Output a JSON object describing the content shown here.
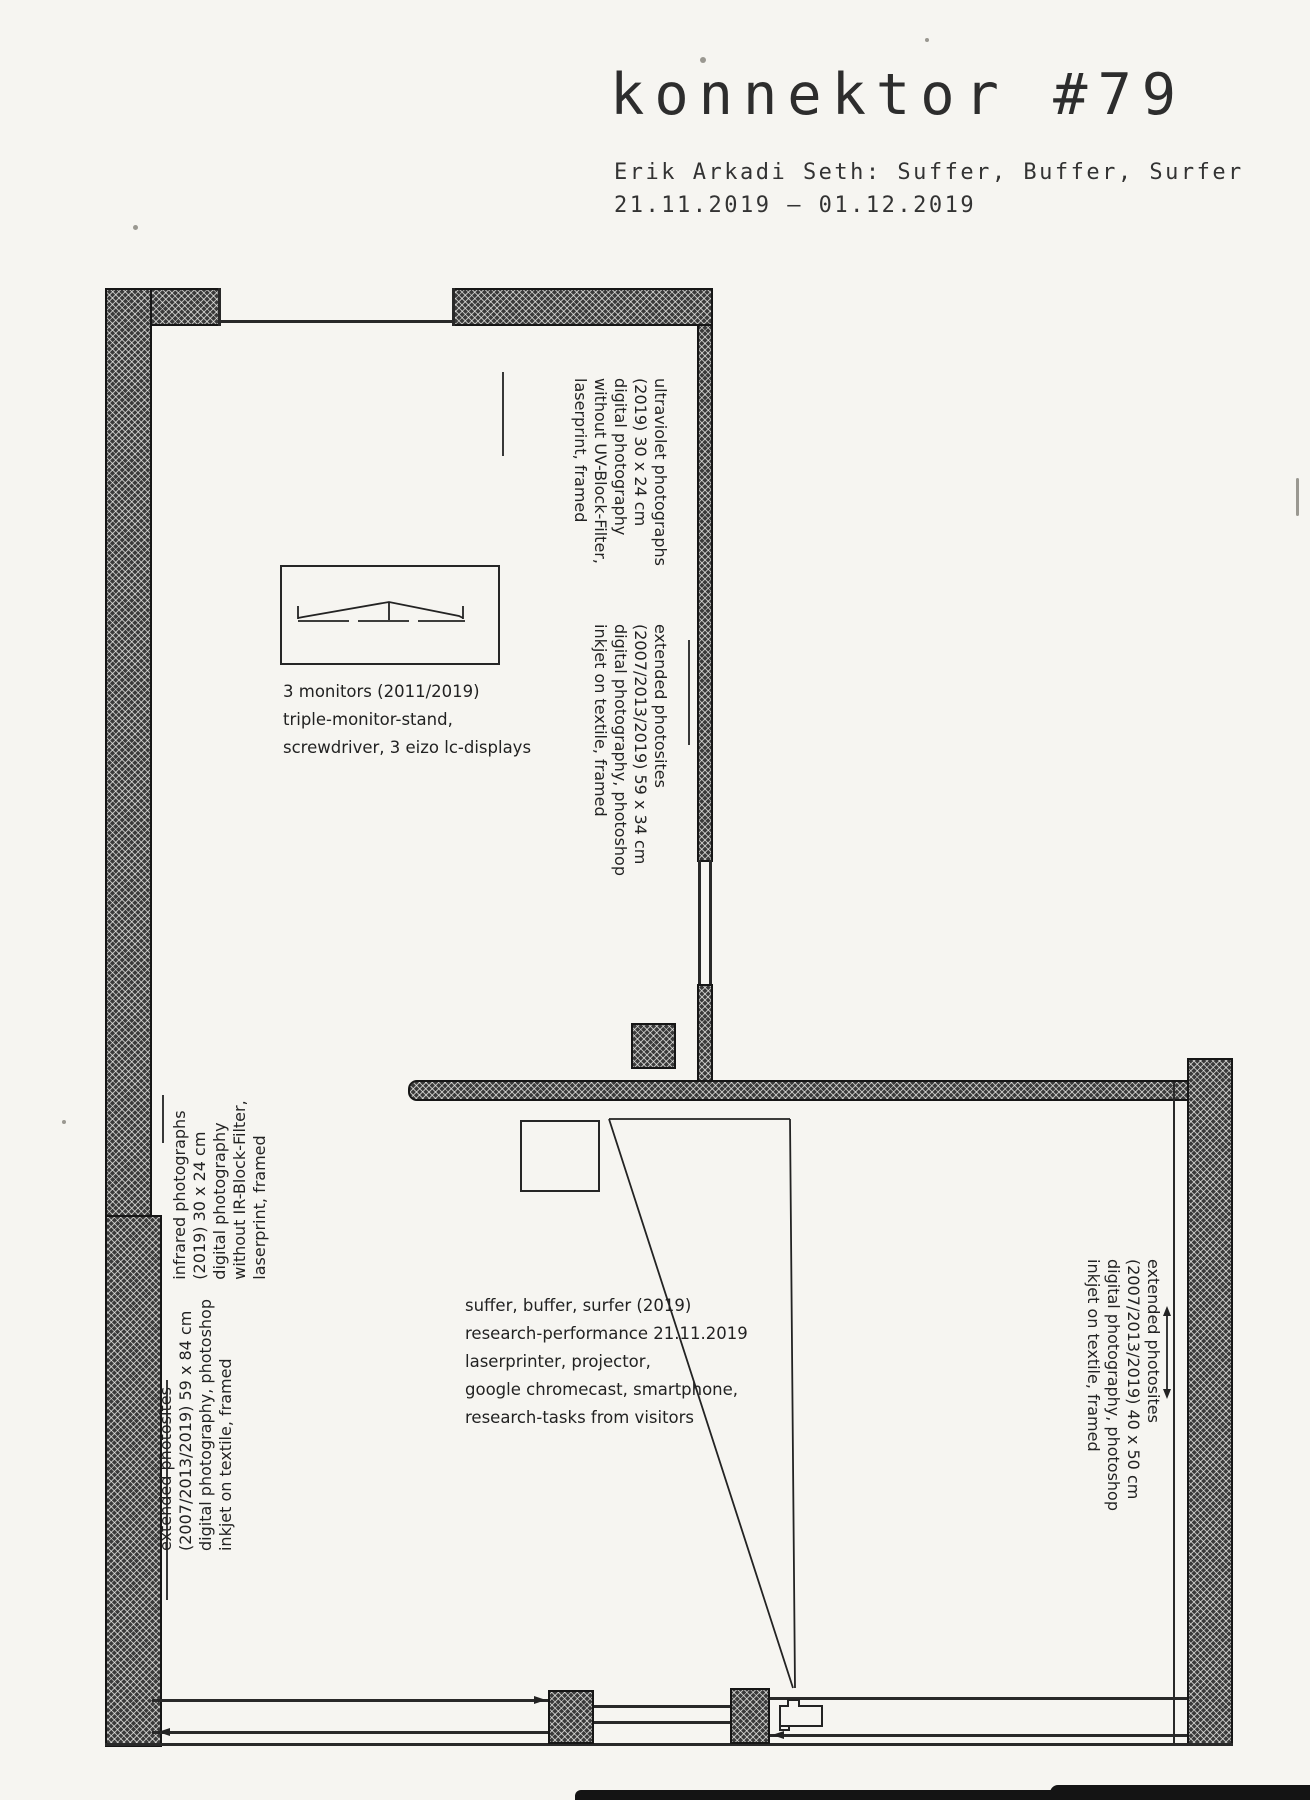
{
  "header": {
    "title": "konnektor #79",
    "subtitle": "Erik Arkadi Seth: Suffer, Buffer, Surfer",
    "dates": "21.11.2019 – 01.12.2019"
  },
  "labels": {
    "ultraviolet": {
      "lines": [
        "ultraviolet photographs",
        "(2019) 30 x 24 cm",
        "digital photography",
        "without UV-Block-Filter,",
        "laserprint, framed"
      ]
    },
    "extended_upper_right": {
      "lines": [
        "extended photosites",
        "(2007/2013/2019) 59 x 34 cm",
        "digital photography, photoshop",
        "inkjet on textile, framed"
      ]
    },
    "monitors": {
      "lines": [
        "3 monitors (2011/2019)",
        "triple-monitor-stand,",
        "screwdriver, 3 eizo lc-displays"
      ]
    },
    "infrared": {
      "lines": [
        "infrared photographs",
        "(2019) 30 x 24 cm",
        "digital photography",
        "without IR-Block-Filter,",
        "laserprint, framed"
      ]
    },
    "extended_left": {
      "lines": [
        "extended photosites",
        "(2007/2013/2019) 59 x 84 cm",
        "digital photography, photoshop",
        "inkjet on textile, framed"
      ]
    },
    "performance": {
      "lines": [
        "suffer, buffer, surfer (2019)",
        "research-performance 21.11.2019",
        "laserprinter, projector,",
        "google chromecast, smartphone,",
        "research-tasks from visitors"
      ]
    },
    "extended_lower_right": {
      "lines": [
        "extended photosites",
        "(2007/2013/2019) 40 x 50 cm",
        "digital photography, photoshop",
        "inkjet on textile, framed"
      ]
    }
  },
  "colors": {
    "paper": "#f6f5f1",
    "ink": "#1f1f1f",
    "wall": "#3a3a3a"
  }
}
